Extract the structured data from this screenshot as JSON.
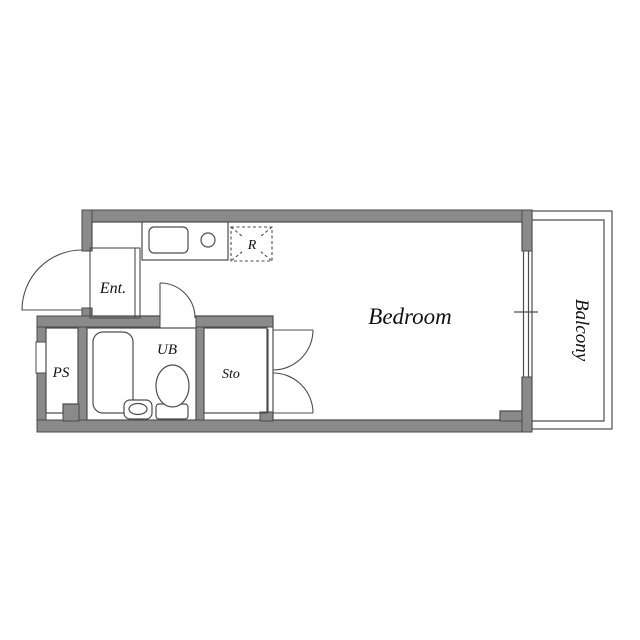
{
  "floorplan": {
    "rooms": {
      "entrance": {
        "label": "Ent."
      },
      "pipe_space": {
        "label": "PS"
      },
      "unit_bath": {
        "label": "UB"
      },
      "storage": {
        "label": "Sto"
      },
      "bedroom": {
        "label": "Bedroom"
      },
      "balcony": {
        "label": "Balcony"
      },
      "refrigerator": {
        "label": "R"
      }
    },
    "colors": {
      "background": "#ffffff",
      "wall_fill": "#8a8a8a",
      "wall_outline": "#4a4a4a",
      "line": "#4d4d4d",
      "text": "#111111"
    }
  }
}
